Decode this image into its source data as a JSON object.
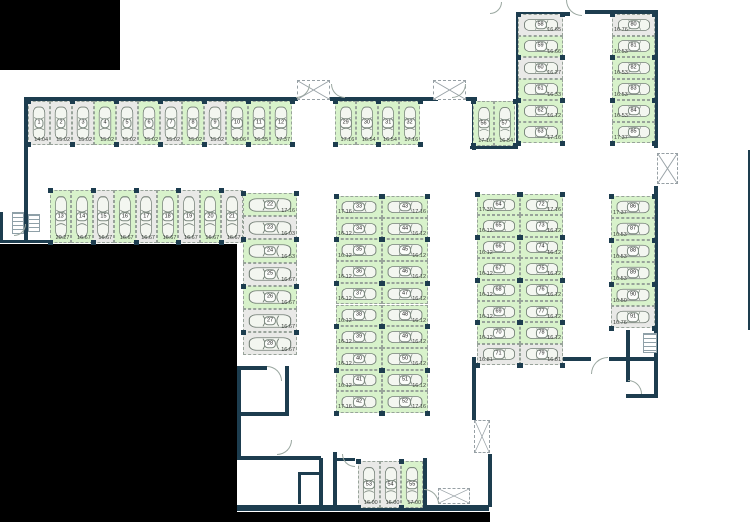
{
  "plan": {
    "title": "underground-parking-floor-plan",
    "legend": {
      "free_color": "#d8f2cb",
      "occupied_color": "#e9e9e7",
      "wall_color": "#1d3d4f",
      "outside_color": "#000000"
    },
    "outside_blocks": [
      [
        0,
        0,
        120,
        70
      ],
      [
        0,
        244,
        237,
        278
      ],
      [
        237,
        512,
        253,
        10
      ]
    ],
    "walls": [
      [
        24,
        97,
        274,
        4
      ],
      [
        24,
        97,
        4,
        146
      ],
      [
        0,
        240,
        82,
        3
      ],
      [
        0,
        212,
        3,
        31
      ],
      [
        330,
        97,
        108,
        4
      ],
      [
        466,
        97,
        11,
        4
      ],
      [
        472,
        97,
        4,
        53
      ],
      [
        470,
        146,
        48,
        3
      ],
      [
        516,
        12,
        4,
        134
      ],
      [
        516,
        12,
        54,
        4
      ],
      [
        585,
        10,
        73,
        4
      ],
      [
        654,
        12,
        4,
        136
      ],
      [
        654,
        186,
        4,
        212
      ],
      [
        477,
        357,
        114,
        4
      ],
      [
        609,
        357,
        49,
        4
      ],
      [
        626,
        330,
        4,
        52
      ],
      [
        626,
        394,
        32,
        4
      ],
      [
        237,
        366,
        4,
        92
      ],
      [
        237,
        366,
        30,
        4
      ],
      [
        285,
        366,
        4,
        48
      ],
      [
        237,
        412,
        52,
        4
      ],
      [
        237,
        456,
        84,
        4
      ],
      [
        319,
        458,
        4,
        50
      ],
      [
        298,
        472,
        22,
        3
      ],
      [
        298,
        472,
        3,
        32
      ],
      [
        333,
        452,
        4,
        56
      ],
      [
        333,
        458,
        22,
        3
      ],
      [
        423,
        458,
        4,
        50
      ],
      [
        237,
        505,
        252,
        6
      ],
      [
        488,
        454,
        4,
        53
      ],
      [
        472,
        357,
        4,
        63
      ],
      [
        748,
        150,
        2,
        180
      ]
    ],
    "shafts": [
      [
        297,
        80,
        33,
        20
      ],
      [
        433,
        80,
        33,
        20
      ],
      [
        657,
        153,
        21,
        31
      ],
      [
        474,
        420,
        16,
        33
      ],
      [
        438,
        488,
        32,
        16
      ]
    ],
    "stairs": [
      [
        12,
        212,
        12,
        22
      ],
      [
        28,
        214,
        12,
        18
      ],
      [
        643,
        333,
        14,
        20
      ]
    ],
    "arcs": [
      [
        296,
        84,
        14,
        "br"
      ],
      [
        331,
        84,
        14,
        "bl"
      ],
      [
        452,
        84,
        14,
        "br"
      ],
      [
        566,
        0,
        16,
        "bl"
      ],
      [
        490,
        2,
        12,
        "br"
      ],
      [
        591,
        357,
        17,
        "tl"
      ],
      [
        267,
        366,
        15,
        "tr"
      ],
      [
        277,
        440,
        15,
        "br"
      ],
      [
        342,
        454,
        13,
        "bl"
      ],
      [
        424,
        489,
        15,
        "tr"
      ],
      [
        14,
        224,
        12,
        "br"
      ],
      [
        628,
        380,
        14,
        "tr"
      ]
    ],
    "groups": [
      {
        "id": "row-top",
        "x": 28,
        "y": 101,
        "sw": 22,
        "sh": 44,
        "dir": "row",
        "vp": "bottom",
        "spots": [
          [
            1,
            "14.04",
            "o"
          ],
          [
            2,
            "15.02",
            "o"
          ],
          [
            3,
            "15.02",
            "o"
          ],
          [
            4,
            "15.02",
            "f"
          ],
          [
            5,
            "15.02",
            "o"
          ],
          [
            6,
            "15.02",
            "f"
          ],
          [
            7,
            "15.02",
            "o"
          ],
          [
            8,
            "15.02",
            "f"
          ],
          [
            9,
            "15.02",
            "o"
          ],
          [
            10,
            "16.06",
            "f"
          ],
          [
            11,
            "16.35",
            "f"
          ],
          [
            12,
            "17.37",
            "f"
          ]
        ]
      },
      {
        "id": "row-second",
        "x": 50,
        "y": 190,
        "sw": 21.4,
        "sh": 53,
        "dir": "row",
        "vp": "bottom",
        "spots": [
          [
            13,
            "20.27",
            "f"
          ],
          [
            14,
            "16.67",
            "f"
          ],
          [
            15,
            "16.67",
            "o"
          ],
          [
            16,
            "16.67",
            "f"
          ],
          [
            17,
            "16.67",
            "o"
          ],
          [
            18,
            "16.67",
            "f"
          ],
          [
            19,
            "16.67",
            "o"
          ],
          [
            20,
            "16.67",
            "f"
          ],
          [
            21,
            "16.67",
            "o"
          ]
        ]
      },
      {
        "id": "col-left",
        "x": 243,
        "y": 193,
        "sw": 54,
        "sh": 23.2,
        "dir": "col",
        "vp": "right",
        "spots": [
          [
            22,
            "17.16",
            "f"
          ],
          [
            23,
            "16.03",
            "o"
          ],
          [
            24,
            "16.53",
            "f"
          ],
          [
            25,
            "16.67",
            "o"
          ],
          [
            26,
            "16.67",
            "f"
          ],
          [
            27,
            "16.67",
            "o"
          ],
          [
            28,
            "16.67",
            "o"
          ]
        ]
      },
      {
        "id": "row-top-middle",
        "x": 335,
        "y": 101,
        "sw": 21.3,
        "sh": 44,
        "dir": "row",
        "vp": "bottom",
        "spots": [
          [
            29,
            "17.16",
            "f"
          ],
          [
            30,
            "16.54",
            "f"
          ],
          [
            31,
            "16.54",
            "f"
          ],
          [
            32,
            "17.16",
            "f"
          ]
        ]
      },
      {
        "id": "col-middle-left",
        "x": 336,
        "y": 196,
        "sw": 46,
        "sh": 21.7,
        "dir": "col",
        "vp": "left",
        "spots": [
          [
            33,
            "17.16",
            "f"
          ],
          [
            34,
            "16.12",
            "f"
          ],
          [
            35,
            "16.12",
            "f"
          ],
          [
            36,
            "16.12",
            "f"
          ],
          [
            37,
            "16.12",
            "f"
          ],
          [
            38,
            "16.12",
            "f"
          ],
          [
            39,
            "16.12",
            "f"
          ],
          [
            40,
            "16.12",
            "f"
          ],
          [
            41,
            "16.12",
            "f"
          ],
          [
            42,
            "17.16",
            "f"
          ]
        ]
      },
      {
        "id": "col-middle-right",
        "x": 382,
        "y": 196,
        "sw": 46,
        "sh": 21.7,
        "dir": "col",
        "vp": "right",
        "spots": [
          [
            43,
            "17.16",
            "f"
          ],
          [
            44,
            "16.12",
            "f"
          ],
          [
            45,
            "16.12",
            "f"
          ],
          [
            46,
            "16.12",
            "f"
          ],
          [
            47,
            "16.12",
            "f"
          ],
          [
            48,
            "16.12",
            "f"
          ],
          [
            49,
            "16.12",
            "f"
          ],
          [
            50,
            "16.12",
            "f"
          ],
          [
            51,
            "16.12",
            "f"
          ],
          [
            52,
            "17.16",
            "f"
          ]
        ]
      },
      {
        "id": "row-bottom",
        "x": 358,
        "y": 461,
        "sw": 21.7,
        "sh": 47,
        "dir": "row",
        "vp": "bottom",
        "spots": [
          [
            53,
            "16.00",
            "o"
          ],
          [
            54,
            "16.00",
            "o"
          ],
          [
            55,
            "17.00",
            "f"
          ]
        ]
      },
      {
        "id": "row-topright-pair",
        "x": 473,
        "y": 101,
        "sw": 21,
        "sh": 45,
        "dir": "row",
        "vp": "bottom",
        "spots": [
          [
            56,
            "17.16",
            "f"
          ],
          [
            57,
            "16.54",
            "f"
          ]
        ]
      },
      {
        "id": "col-topright-left",
        "x": 518,
        "y": 14,
        "sw": 45,
        "sh": 21.5,
        "dir": "col",
        "vp": "right",
        "spots": [
          [
            58,
            "16.65",
            "o"
          ],
          [
            59,
            "16.66",
            "f"
          ],
          [
            60,
            "16.27",
            "o"
          ],
          [
            61,
            "16.33",
            "f"
          ],
          [
            62,
            "16.12",
            "f"
          ],
          [
            63,
            "17.16",
            "f"
          ]
        ]
      },
      {
        "id": "col-topright-right",
        "x": 612,
        "y": 14,
        "sw": 43,
        "sh": 21.5,
        "dir": "col",
        "vp": "left",
        "spots": [
          [
            80,
            "16.76",
            "o"
          ],
          [
            81,
            "16.53",
            "f"
          ],
          [
            82,
            "16.53",
            "f"
          ],
          [
            83,
            "16.53",
            "f"
          ],
          [
            84,
            "16.53",
            "f"
          ],
          [
            85,
            "17.37",
            "f"
          ]
        ]
      },
      {
        "id": "col-right-left",
        "x": 477,
        "y": 194,
        "sw": 43,
        "sh": 21.4,
        "dir": "col",
        "vp": "left",
        "spots": [
          [
            64,
            "17.30",
            "f"
          ],
          [
            65,
            "16.12",
            "f"
          ],
          [
            66,
            "16.12",
            "f"
          ],
          [
            67,
            "16.12",
            "f"
          ],
          [
            68,
            "16.12",
            "f"
          ],
          [
            69,
            "16.12",
            "f"
          ],
          [
            70,
            "16.12",
            "f"
          ],
          [
            71,
            "16.81",
            "o"
          ]
        ]
      },
      {
        "id": "col-right-right",
        "x": 520,
        "y": 194,
        "sw": 43,
        "sh": 21.4,
        "dir": "col",
        "vp": "right",
        "spots": [
          [
            72,
            "17.16",
            "f"
          ],
          [
            73,
            "16.12",
            "f"
          ],
          [
            74,
            "16.12",
            "f"
          ],
          [
            75,
            "16.12",
            "f"
          ],
          [
            76,
            "16.12",
            "f"
          ],
          [
            77,
            "16.12",
            "f"
          ],
          [
            78,
            "16.12",
            "f"
          ],
          [
            79,
            "16.81",
            "o"
          ]
        ]
      },
      {
        "id": "col-far-right",
        "x": 611,
        "y": 196,
        "sw": 44,
        "sh": 22,
        "dir": "col",
        "vp": "left",
        "spots": [
          [
            86,
            "17.37",
            "f"
          ],
          [
            87,
            "16.53",
            "f"
          ],
          [
            88,
            "16.53",
            "f"
          ],
          [
            89,
            "16.53",
            "f"
          ],
          [
            90,
            "16.50",
            "f"
          ],
          [
            91,
            "16.76",
            "o"
          ]
        ]
      }
    ]
  }
}
